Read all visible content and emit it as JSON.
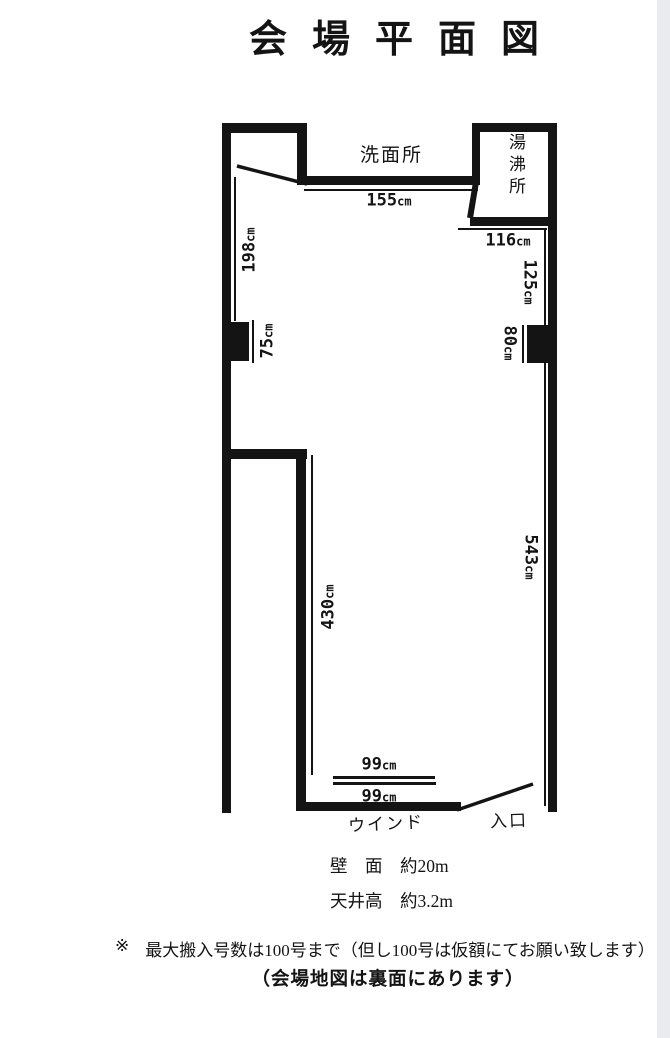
{
  "title": "会場平面図",
  "plan": {
    "washroom_label": "洗面所",
    "hot_water_label": "湯沸所",
    "window_label": "ウインド",
    "entrance_label": "入口",
    "dims": {
      "w155": {
        "value": "155",
        "unit": "cm"
      },
      "w116": {
        "value": "116",
        "unit": "cm"
      },
      "w125": {
        "value": "125",
        "unit": "cm"
      },
      "w80": {
        "value": "80",
        "unit": "cm"
      },
      "w198": {
        "value": "198",
        "unit": "cm"
      },
      "w75": {
        "value": "75",
        "unit": "cm"
      },
      "w430": {
        "value": "430",
        "unit": "cm"
      },
      "w543": {
        "value": "543",
        "unit": "cm"
      },
      "w99a": {
        "value": "99",
        "unit": "cm"
      },
      "w99b": {
        "value": "99",
        "unit": "cm"
      }
    }
  },
  "specs": {
    "wall": "壁　面　約20m",
    "ceiling": "天井高　約3.2m"
  },
  "notes": {
    "mark": "※",
    "line1": "最大搬入号数は100号まで（但し100号は仮額にてお願い致します）",
    "line2": "（会場地図は裏面にあります）"
  },
  "colors": {
    "ink": "#141414",
    "paper": "#ffffff",
    "scan_edge": "#e9ebee"
  }
}
